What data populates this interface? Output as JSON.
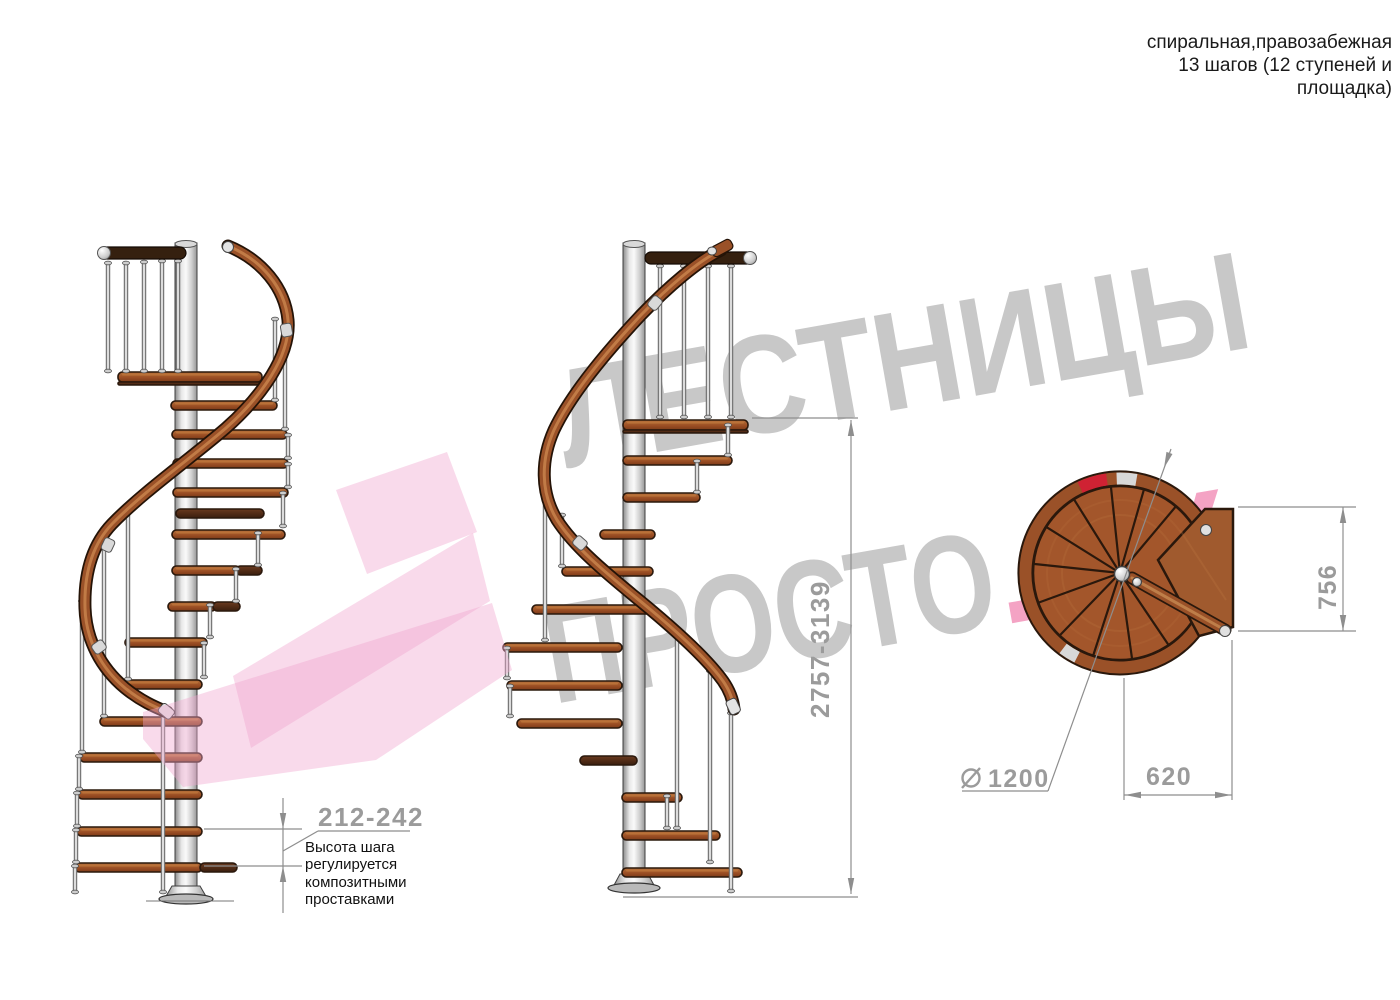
{
  "title_block": {
    "line1": "спиральная,правозабежная",
    "line2": "13 шагов (12 ступеней и",
    "line3": "площадка)"
  },
  "watermark": {
    "word_top": "ЛЕСТНИЦЫ",
    "word_bottom": "ПРОСТО",
    "word_suffix": ".РУ"
  },
  "dimensions": {
    "step_height": "212-242",
    "total_height": "2757-3139",
    "platform_depth": "756",
    "platform_width": "620",
    "diameter": "1200"
  },
  "note": {
    "line1": "Высота шага",
    "line2": "регулируется",
    "line3": "композитными",
    "line4": "проставками"
  },
  "colors": {
    "wood": "#a3562b",
    "wood_dark": "#4a2614",
    "rail_wood": "#9a5128",
    "metal": "#c9c9c9",
    "outline": "#2a180c",
    "dimension_lines": "#8e8e8e",
    "dimension_text": "#9b9b9b",
    "text": "#1a1a1a",
    "red_accent": "#cf2233",
    "pink_logo": "#f0a8cf",
    "watermark_gray": "#c8c8c8",
    "watermark_pink": "#f4a3c4"
  }
}
